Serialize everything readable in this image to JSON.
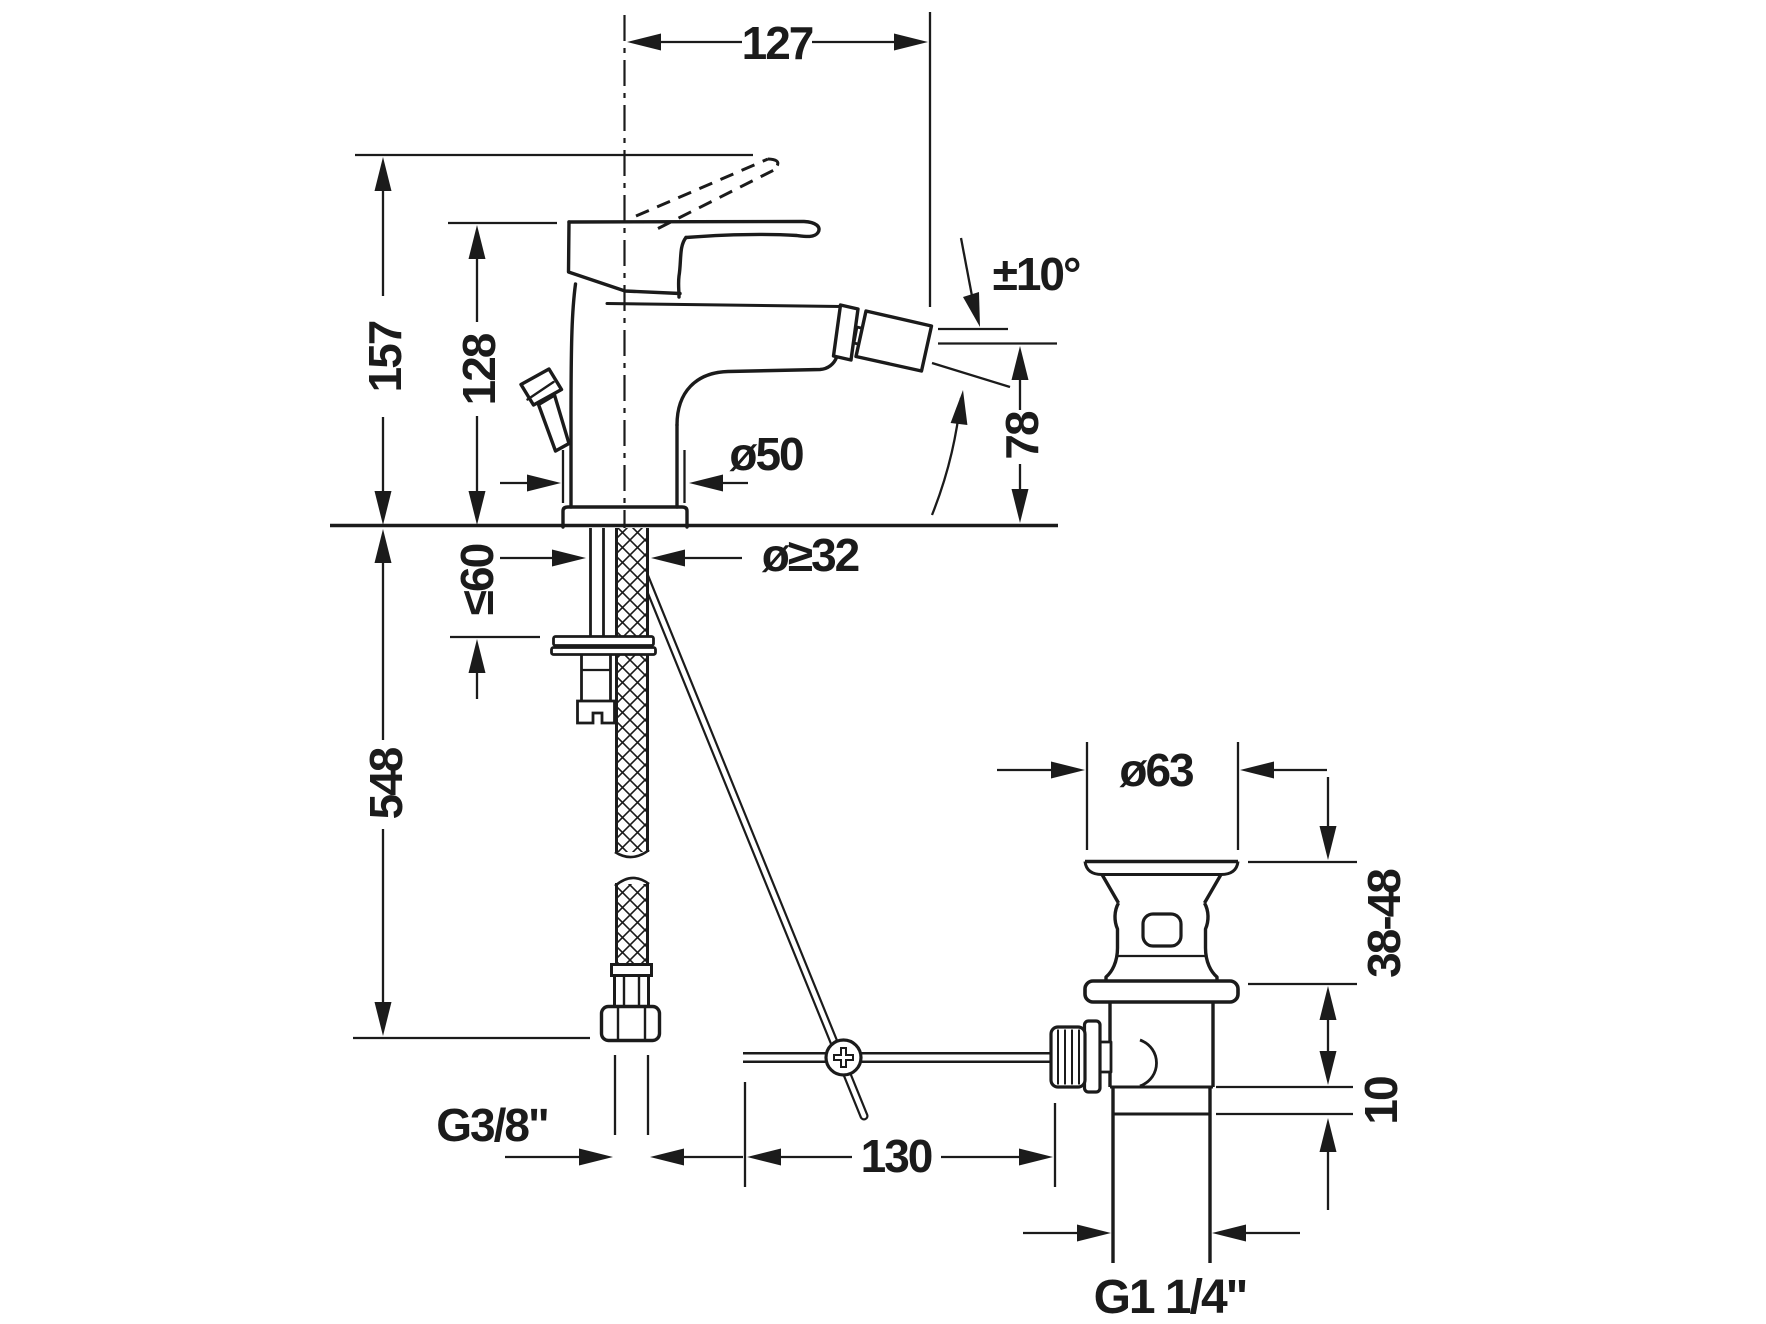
{
  "drawing": {
    "type": "technical-dimension-drawing",
    "product": "single-lever bidet mixer with pop-up waste set",
    "background_color": "#ffffff",
    "line_color": "#1b1b1b",
    "labels": {
      "reach": "127",
      "height_total": "157",
      "height_body": "128",
      "swivel_angle": "±10°",
      "spout_height": "78",
      "base_diameter": "ø50",
      "hole_diameter": "ø≥32",
      "max_deck_thickness": "≤60",
      "hose_length": "548",
      "waste_diameter": "ø63",
      "clamp_range": "38-48",
      "collar_height": "10",
      "supply_thread": "G3/8\"",
      "rod_length": "130",
      "waste_thread": "G1 1/4\""
    }
  }
}
